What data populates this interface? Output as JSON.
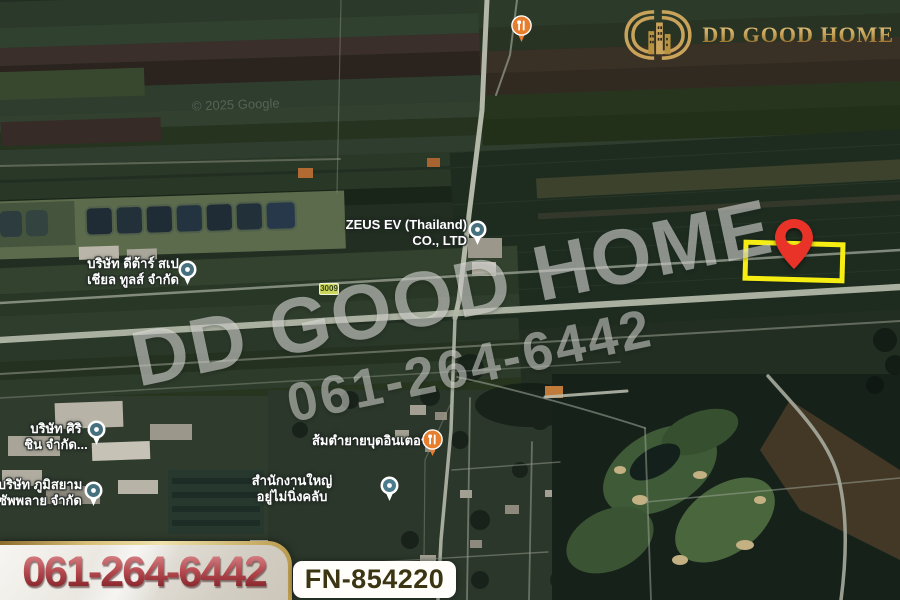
{
  "logo": {
    "brand": "DD GOOD HOME"
  },
  "watermark": {
    "line1": "DD GOOD HOME",
    "line2": "061-264-6442"
  },
  "attribution": {
    "text": "© 2025 Google"
  },
  "contact": {
    "phone": "061-264-6442"
  },
  "listing": {
    "code": "FN-854220"
  },
  "map": {
    "road_badge": "3009",
    "labels": {
      "zeus": {
        "line1": "ZEUS EV (Thailand)",
        "line2": "CO., LTD"
      },
      "dtar": {
        "line1": "บริษัท ดีต้าร์ สเป",
        "line2": "เชียล ทูลส์ จำกัด"
      },
      "siri": {
        "line1": "บริษัท ศิริ",
        "line2": "ชิน จำกัด..."
      },
      "phumsiam": {
        "line1": "บริษัท ภูมิสยาม",
        "line2": "ซัพพลาย จำกัด"
      },
      "somtam": {
        "label": "ส้มตำยายบุดอินเตอร์"
      },
      "office": {
        "line1": "สำนักงานใหญ่",
        "line2": "อยู่ไม่นิ่งคลับ"
      }
    },
    "icons": {
      "place_pin": "circle-dot-place-pin",
      "restaurant_pin": "fork-knife-pin",
      "target_pin": "red-map-pin"
    },
    "colors": {
      "highlight_rect": "#f6ed12",
      "pin_red": "#e93328",
      "brand_gold": "#c9a35a",
      "phone_red": "#9c3038",
      "road": "#b2b7a8"
    }
  }
}
